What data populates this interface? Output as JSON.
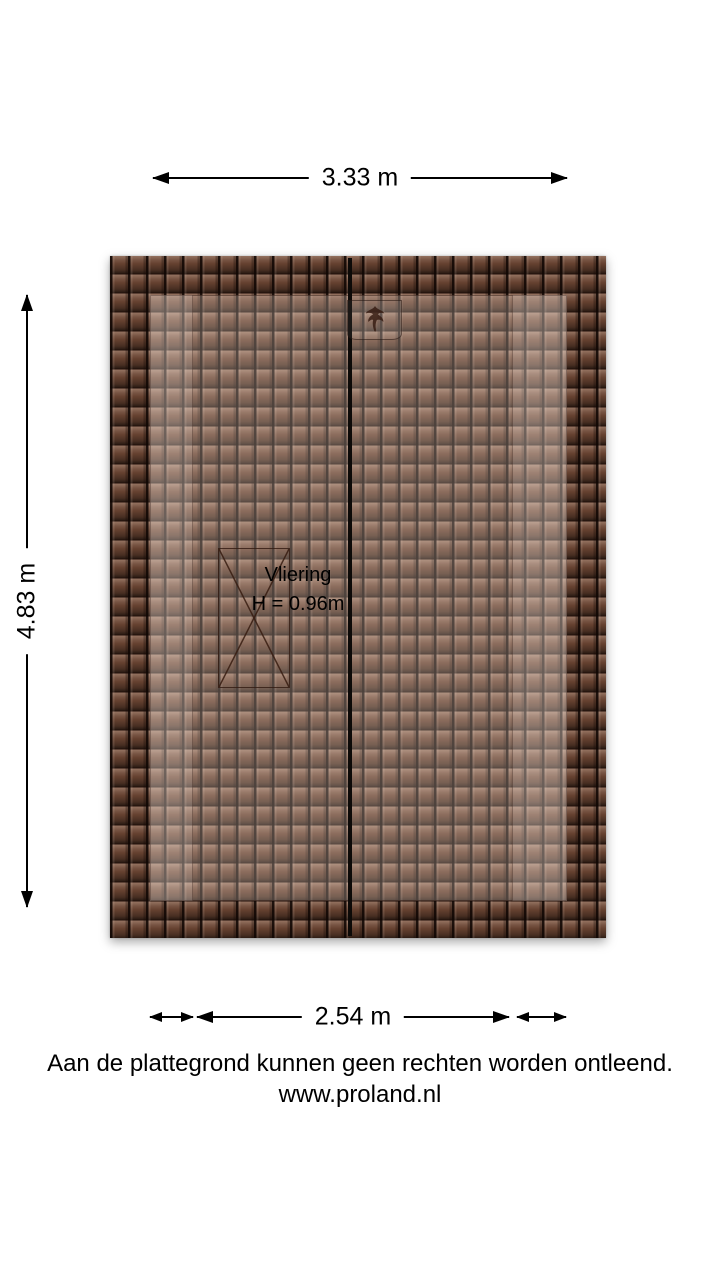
{
  "plan": {
    "room_name": "Vliering",
    "room_height": "H = 0.96m"
  },
  "dimensions": {
    "top": "3.33 m",
    "side": "4.83 m",
    "bottom": "2.54 m"
  },
  "footer": {
    "disclaimer": "Aan de plattegrond kunnen geen rechten worden ontleend.",
    "website": "www.proland.nl"
  },
  "colors": {
    "background": "#ffffff",
    "text": "#000000",
    "dimension": "#000000",
    "roof_tile": "#64402f",
    "roof_joint": "#1a0d08",
    "ridge_line": "#0d0a08"
  },
  "icons": {
    "roof_hatch": "roof-hatch-icon",
    "stair_opening": "crossed-opening-symbol",
    "arrows": "dimension-arrowheads"
  }
}
